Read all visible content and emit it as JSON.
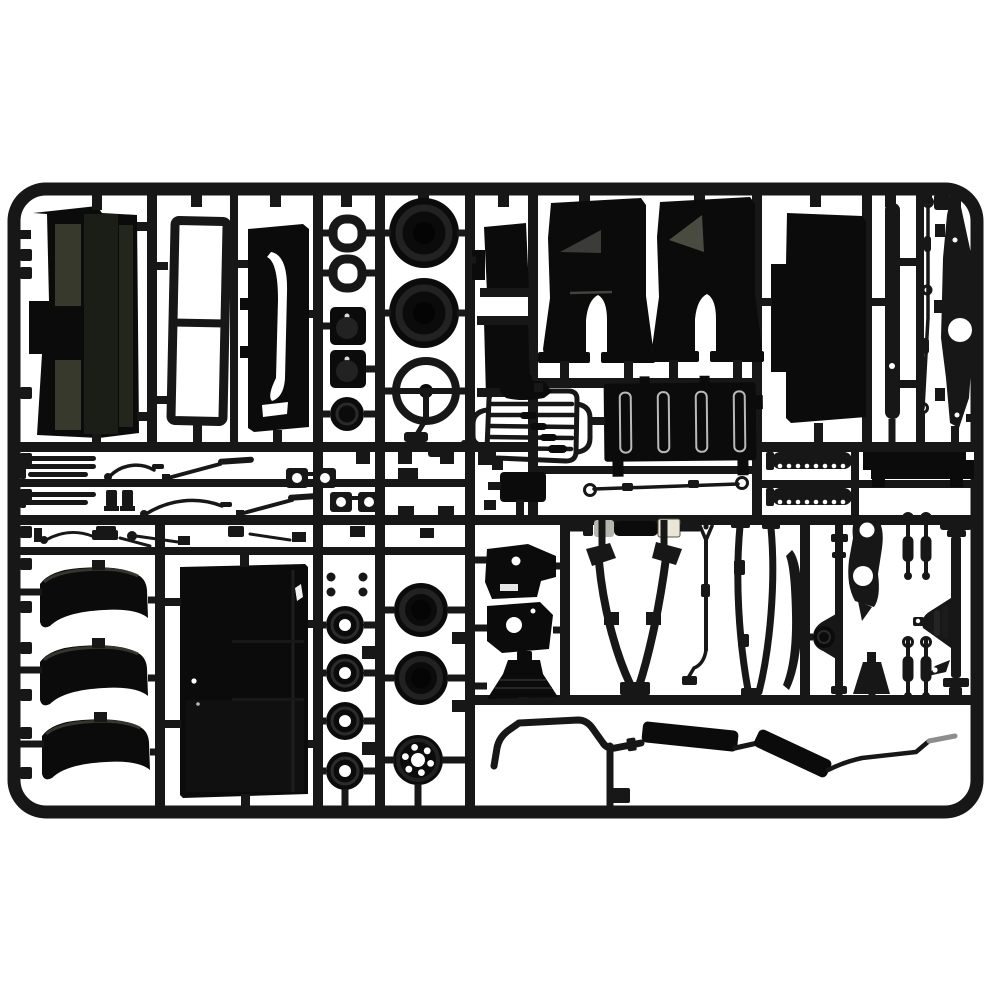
{
  "scene": {
    "subject": "Photograph of a black injection-molded plastic model kit sprue (parts tree) for a truck kit, on a plain white background",
    "palette": {
      "paper_white": "#ffffff",
      "plastic": "#171717",
      "plastic_deep": "#0b0b0b",
      "plastic_soft": "#222222",
      "olive_sheen": "#3b3e2f",
      "olive_dark": "#2a2d22",
      "grey_sheen": "#50514a",
      "silver": "#b6b6ae",
      "cream": "#e9e6d8",
      "steel_grey": "#8d8d8d"
    },
    "sprue": {
      "frame_shape": "rounded rectangle",
      "plastic_finish": "gloss black",
      "parts": [
        {
          "id": "sprue-frame",
          "label": "rectangular runner frame with internal grid"
        },
        {
          "id": "cab-floor-panel",
          "label": "cab floor panel with olive sheen"
        },
        {
          "id": "window-frame",
          "label": "open window frame with center bar"
        },
        {
          "id": "door-panel-upper",
          "label": "narrow door panel"
        },
        {
          "id": "lamp-rings",
          "label": "lamp bezel rings",
          "count": 2
        },
        {
          "id": "headlight-pods",
          "label": "square headlight pods",
          "count": 2
        },
        {
          "id": "horn-disc",
          "label": "horn disc"
        },
        {
          "id": "front-tires",
          "label": "tires",
          "count": 2
        },
        {
          "id": "steering-wheel",
          "label": "three-spoke steering wheel"
        },
        {
          "id": "mounting-brackets",
          "label": "mounting brackets",
          "count": 2
        },
        {
          "id": "cab-corner-panels",
          "label": "cab corner panels with notch",
          "count": 2
        },
        {
          "id": "roof-panel",
          "label": "large stepped panel"
        },
        {
          "id": "chassis-bar",
          "label": "long flat bar"
        },
        {
          "id": "brake-line",
          "label": "thin brake line rod with eyelets"
        },
        {
          "id": "chassis-rail",
          "label": "tapered chassis rail with round hole"
        },
        {
          "id": "running-boards",
          "label": "slatted running boards",
          "count": 2
        },
        {
          "id": "wiper-arms",
          "label": "wiper arms and small levers",
          "count": 5
        },
        {
          "id": "pipe-clamps",
          "label": "clamps with holes",
          "count": 4
        },
        {
          "id": "radiator-grille",
          "label": "outline radiator grille with slats"
        },
        {
          "id": "radiator",
          "label": "radiator block with vertical slots"
        },
        {
          "id": "tie-rod",
          "label": "tie rod with eyelets"
        },
        {
          "id": "shackle-springs",
          "label": "leaf springs with rivet dots",
          "count": 2
        },
        {
          "id": "sill-bar",
          "label": "black sill bar"
        },
        {
          "id": "mudguards",
          "label": "curved mudguards",
          "count": 3
        },
        {
          "id": "door-panel-lower",
          "label": "large door panel"
        },
        {
          "id": "brake-drums",
          "label": "brake drums with center hole",
          "count": 4
        },
        {
          "id": "rear-tires",
          "label": "tires",
          "count": 2
        },
        {
          "id": "wheel-rim",
          "label": "wheel rim with stud holes"
        },
        {
          "id": "engine-mounts",
          "label": "engine mount brackets",
          "count": 2
        },
        {
          "id": "intake-horn",
          "label": "flared intake horn"
        },
        {
          "id": "shock-absorber",
          "label": "shock absorber with silver and cream paint"
        },
        {
          "id": "fork-link",
          "label": "forked link rod"
        },
        {
          "id": "leaf-springs",
          "label": "long curved leaf spring blades",
          "count": 4
        },
        {
          "id": "spring-blade",
          "label": "crescent spring blade"
        },
        {
          "id": "axle-bracket",
          "label": "bracket plate with two holes"
        },
        {
          "id": "rear-axle",
          "label": "axle shaft with differential cone"
        },
        {
          "id": "shock-links",
          "label": "small shock links",
          "count": 4
        },
        {
          "id": "front-axle",
          "label": "axle with differential and end caps"
        },
        {
          "id": "funnel-bracket",
          "label": "funnel bracket"
        },
        {
          "id": "anti-roll-bar",
          "label": "bent anti-roll bar"
        },
        {
          "id": "exhaust-system",
          "label": "exhaust pipe with two mufflers and grey tip"
        }
      ]
    }
  }
}
